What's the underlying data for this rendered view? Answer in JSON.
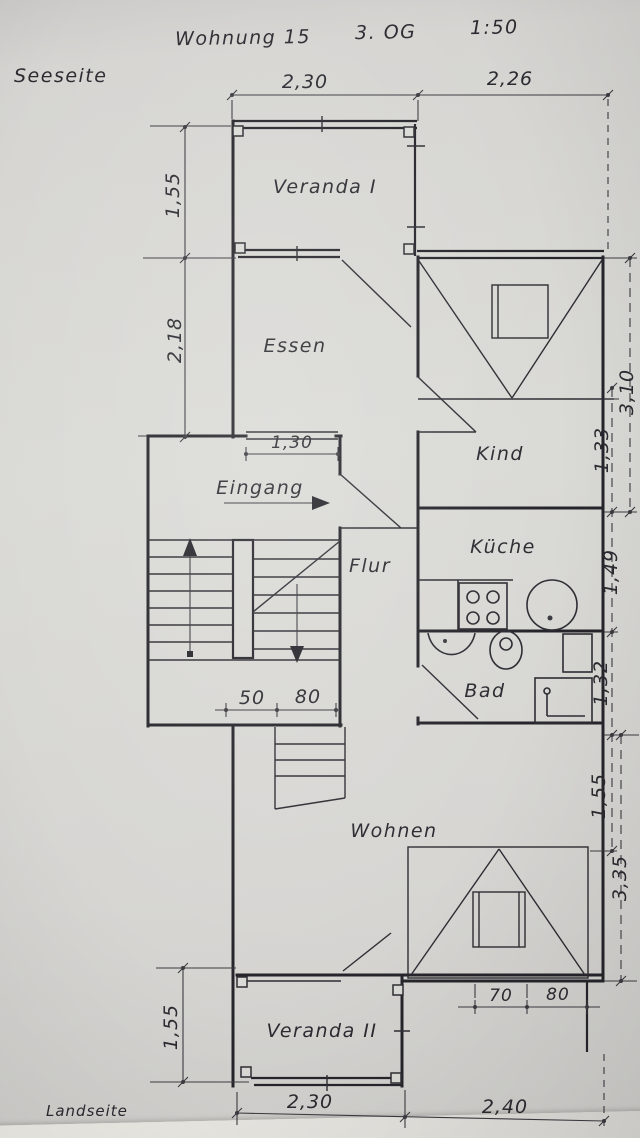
{
  "title": {
    "project": "Wohnung 15",
    "floor": "3. OG",
    "scale": "1:50"
  },
  "orientation": {
    "top": "Seeseite",
    "bottom": "Landseite"
  },
  "rooms": {
    "veranda1": "Veranda I",
    "essen": "Essen",
    "kind": "Kind",
    "eingang": "Eingang",
    "flur": "Flur",
    "kueche": "Küche",
    "bad": "Bad",
    "wohnen": "Wohnen",
    "veranda2": "Veranda II"
  },
  "dims": {
    "top1": "2,30",
    "top2": "2,26",
    "left1": "1,55",
    "left2": "2,18",
    "left3": "1,55",
    "right_outer_top": "3,10",
    "right1": "1,33",
    "right2": "1,49",
    "right3": "1,32",
    "right4": "1,55",
    "right_outer_bottom": "3,35",
    "door": "1,30",
    "stair1": "50",
    "stair2": "80",
    "small1": "70",
    "small2": "80",
    "bottom1": "2,30",
    "bottom2": "2,40"
  },
  "colors": {
    "paper": "#d7d5d2",
    "ink": "#2b2a30"
  }
}
